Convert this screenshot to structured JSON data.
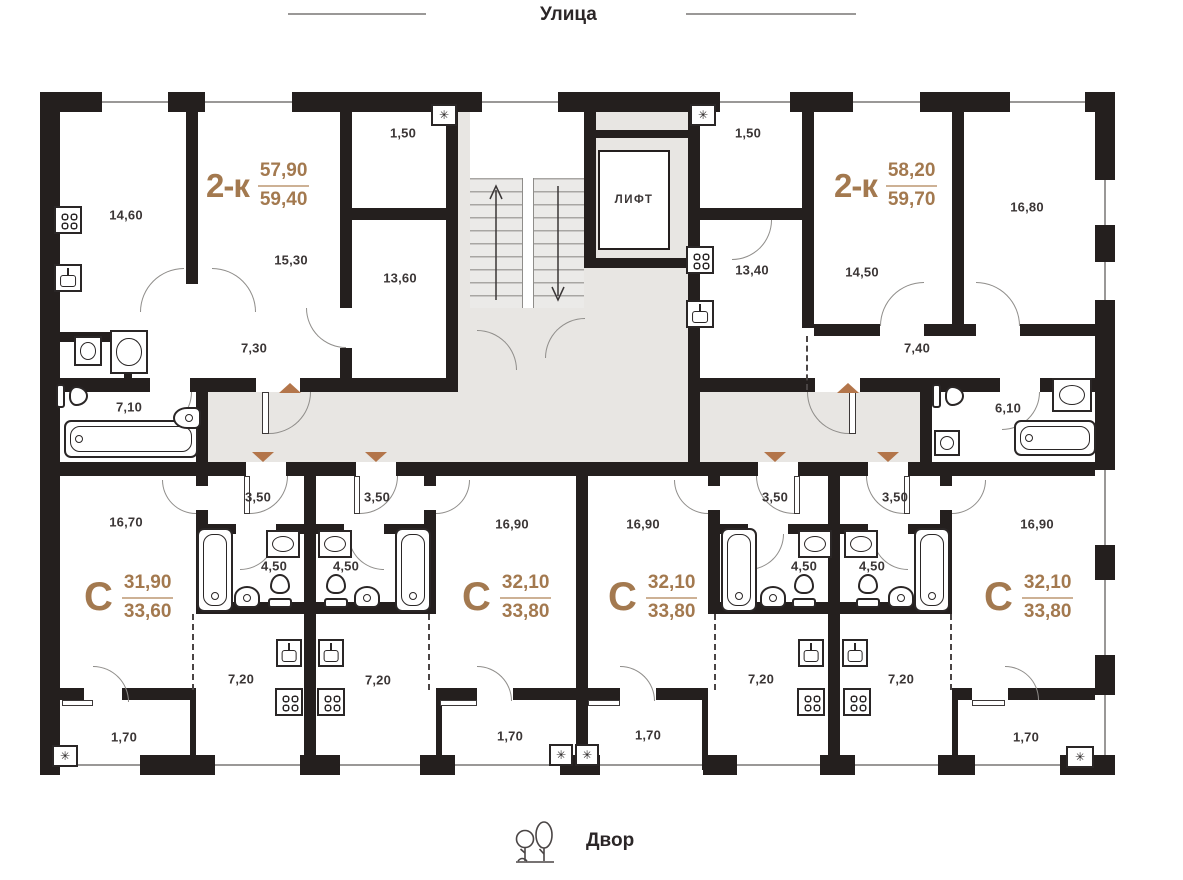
{
  "colors": {
    "wall": "#241f1e",
    "corridor": "#e8e6e3",
    "accent": "#a3794f",
    "arrow": "#b3754a",
    "dim": "#3b3636",
    "line": "#9a9897"
  },
  "street": {
    "label": "Улица"
  },
  "courtyard": {
    "label": "Двор"
  },
  "core": {
    "elevator": "ЛИФТ"
  },
  "symbols": {
    "vent": "✳"
  },
  "apartments": {
    "left2k": {
      "type": "2-к",
      "area_top": "57,90",
      "area_bottom": "59,40",
      "kitchen": "14,60",
      "living": "15,30",
      "loggia": "1,50",
      "room": "13,60",
      "hall": "7,30",
      "bath": "7,10"
    },
    "right2k": {
      "type": "2-к",
      "area_top": "58,20",
      "area_bottom": "59,70",
      "loggia": "1,50",
      "kitchen": "13,40",
      "living": "14,50",
      "room": "16,80",
      "hall": "7,40",
      "bath": "6,10"
    },
    "studio1": {
      "type": "С",
      "area_top": "31,90",
      "area_bottom": "33,60",
      "room": "16,70",
      "hall": "3,50",
      "bath": "4,50",
      "kitchen": "7,20",
      "balcony": "1,70"
    },
    "studio2": {
      "type": "С",
      "area_top": "32,10",
      "area_bottom": "33,80",
      "room": "16,90",
      "hall": "3,50",
      "bath": "4,50",
      "kitchen": "7,20",
      "balcony": "1,70"
    },
    "studio3": {
      "type": "С",
      "area_top": "32,10",
      "area_bottom": "33,80",
      "room": "16,90",
      "hall": "3,50",
      "bath": "4,50",
      "kitchen": "7,20",
      "balcony": "1,70"
    },
    "studio4": {
      "type": "С",
      "area_top": "32,10",
      "area_bottom": "33,80",
      "room": "16,90",
      "hall": "3,50",
      "bath": "4,50",
      "kitchen": "7,20",
      "balcony": "1,70"
    }
  }
}
